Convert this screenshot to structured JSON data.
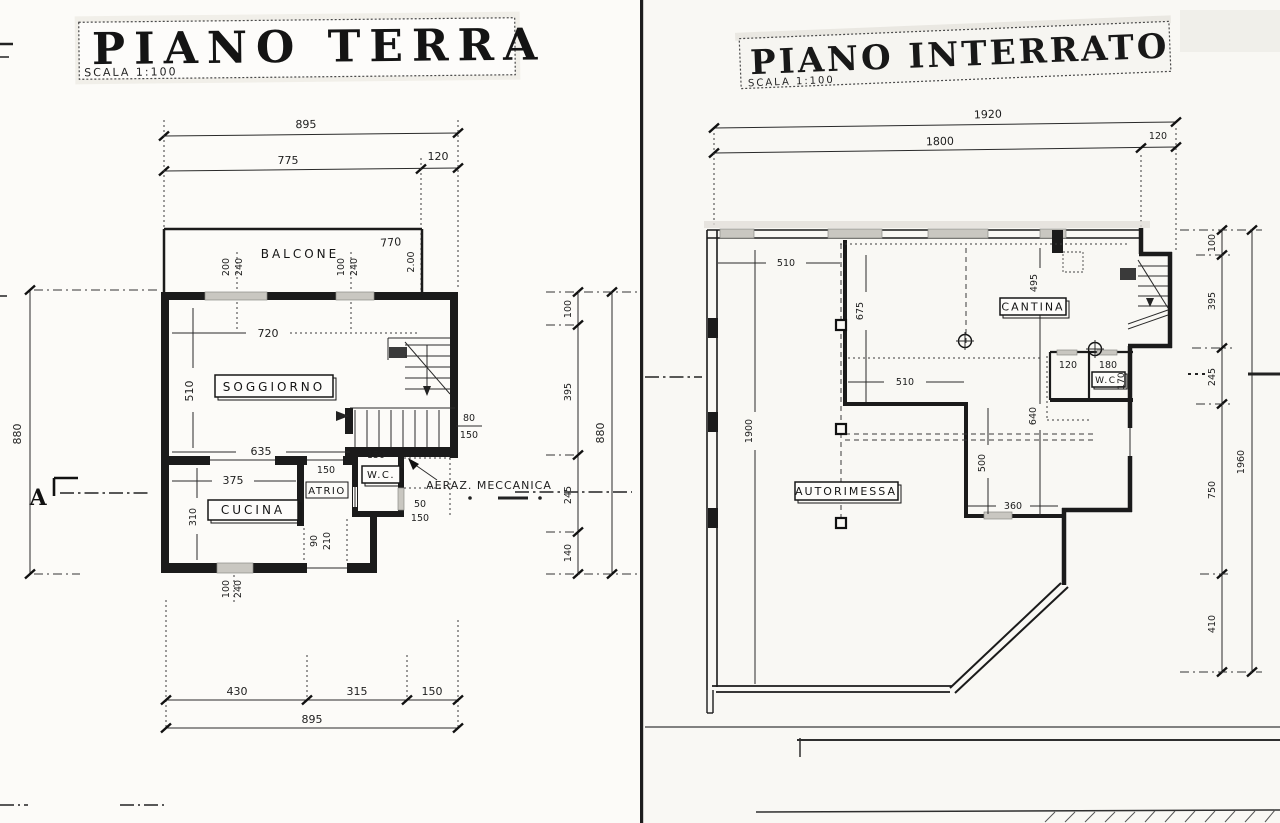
{
  "page": {
    "left_sheet": {
      "title": "PIANO TERRA",
      "scale_note": "SCALA 1:100",
      "section_marker": "A",
      "rooms": {
        "balcone": "BALCONE",
        "soggiorno": "SOGGIORNO",
        "cucina": "CUCINA",
        "atrio": "ATRIO",
        "wc": "W.C.",
        "vent_note": "AERAZ. MECCANICA"
      },
      "dims": {
        "top_total": "895",
        "top_main": "775",
        "top_stair": "120",
        "balcone_width": "770",
        "balcone_depth": "2.00",
        "window_left_width": "200",
        "window_left_height": "240",
        "window_mid_width": "100",
        "window_mid_height": "240",
        "soggiorno_width_top": "720",
        "soggiorno_height": "510",
        "soggiorno_width_bottom": "635",
        "stair_width": "80",
        "stair_width_total": "150",
        "wc_width": "150",
        "atrio_width": "150",
        "cucina_width": "375",
        "cucina_height": "310",
        "vent_width": "50",
        "vent_total": "150",
        "door_width": "90",
        "door_height": "210",
        "window_bottom_width": "100",
        "window_bottom_height": "240",
        "right_seg_1": "100",
        "right_seg_2": "395",
        "right_seg_3": "245",
        "right_seg_4": "140",
        "right_total": "880",
        "left_total": "880",
        "bottom_seg_1": "430",
        "bottom_seg_2": "315",
        "bottom_seg_3": "150",
        "bottom_total": "895"
      }
    },
    "right_sheet": {
      "title": "PIANO INTERRATO",
      "scale_note": "SCALA 1:100",
      "rooms": {
        "cantina": "CANTINA",
        "autorimessa": "AUTORIMESSA",
        "wc": "W.C."
      },
      "dims": {
        "top_total": "1920",
        "top_main": "1800",
        "top_stair": "120",
        "upper_left_width": "510",
        "cantina_left_height": "675",
        "cantina_height": "495",
        "cantina_width": "510",
        "left_height": "1900",
        "wc_seg_1": "120",
        "wc_seg_2": "180",
        "wc_depth": "170",
        "mid_height": "640",
        "court_height": "500",
        "court_width": "360",
        "right_seg_1": "100",
        "right_seg_2": "395",
        "right_seg_3": "245",
        "right_seg_4": "750",
        "right_seg_5": "410",
        "right_total": "1960"
      }
    }
  }
}
